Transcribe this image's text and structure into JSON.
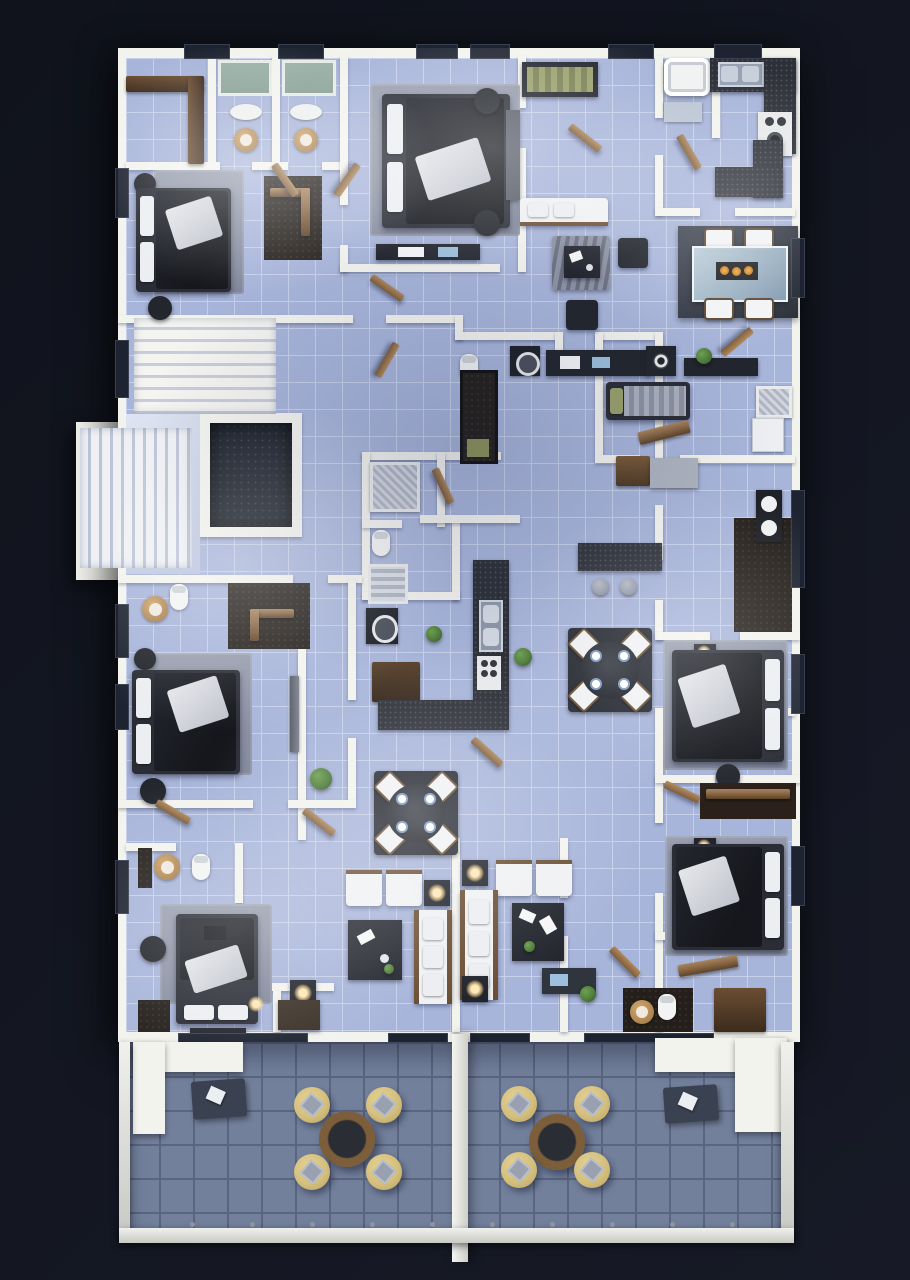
{
  "scene": {
    "type": "3d-floor-plan-render",
    "view": "top-down",
    "description": "Top-down 3D architectural render of a furnished residential apartment floor with a shared tiled terrace at the bottom",
    "visible_text": ""
  },
  "palette": {
    "bg": "#12151f",
    "wall": "#f3f3ee",
    "wall_shade": "#d7d8d4",
    "floor_tile": "#a8b5da",
    "floor_grout": "#c7d0ea",
    "terrace_tile": "#73809c",
    "terrace_grout": "#5a6580",
    "furniture_dark": "#22252d",
    "furniture_darker": "#16181e",
    "wood": "#8a6847",
    "wood_dark": "#5d4328",
    "wardrobe_brown": "#453226",
    "rug_gray": "#8f95a6",
    "chair_yellow": "#d4bf7d",
    "chair_yellow_rim": "#b7a262",
    "plant_green": "#4d7a3a",
    "tub_teal": "#849d93",
    "glass_blue": "#a9c0d2",
    "lamp_glow": "#ffe9b8",
    "counter_speckle": "#2d3038",
    "window_dark": "#1d2330"
  },
  "rooms": [
    {
      "id": "bedroom-top-left",
      "label": "Bedroom with double bed, rug and walk-in closet"
    },
    {
      "id": "twin-bathrooms-top",
      "label": "Two mirrored bathrooms with teal tubs, wood basins and toilets"
    },
    {
      "id": "bedroom-top-center",
      "label": "Master bedroom with large double bed and dresser"
    },
    {
      "id": "entry-lounge",
      "label": "Entry lounge with white sofa, zebra rug and dark armchairs"
    },
    {
      "id": "kitchen-top-right",
      "label": "Kitchen with dark counters, double sink, stove and glass dining table"
    },
    {
      "id": "stairwell",
      "label": "Staircase flights and landing"
    },
    {
      "id": "elevator",
      "label": "Elevator shaft"
    },
    {
      "id": "laundry-corridor",
      "label": "Corridor with washing machine and kitchenette counter"
    },
    {
      "id": "studio-mid-right",
      "label": "Studio room with single bed, desk, fridge and shower"
    },
    {
      "id": "bathroom-mid-right",
      "label": "Bathroom with double vanity on dark tile"
    },
    {
      "id": "bedroom-mid-left",
      "label": "Bedroom with double bed, TV wall and dark wardrobe"
    },
    {
      "id": "kitchen-center",
      "label": "Kitchen with L-counter, sink, stove and breakfast bar"
    },
    {
      "id": "dining-center",
      "label": "Round dining table with four chairs and plates"
    },
    {
      "id": "dining-left",
      "label": "Round dining table with four chairs and plates"
    },
    {
      "id": "living-room-left",
      "label": "Living room with white sofa, armchairs, coffee table, lamp table"
    },
    {
      "id": "living-room-right",
      "label": "Living room with white sofa, armchairs, coffee table, lamp tables"
    },
    {
      "id": "bedroom-right-1",
      "label": "Bedroom with double bed and glowing nightstands"
    },
    {
      "id": "bedroom-right-2",
      "label": "Bedroom with double bed and wardrobe corridor"
    },
    {
      "id": "bedroom-bottom-left",
      "label": "Bedroom with double bed and en-suite bathroom"
    },
    {
      "id": "bathroom-bottom-right",
      "label": "Bathroom with toilet, wood basin and wardrobe"
    },
    {
      "id": "terrace-left",
      "label": "Terrace with round table, four yellow tub chairs and mat"
    },
    {
      "id": "terrace-right",
      "label": "Terrace with round table, four yellow tub chairs and mat"
    }
  ],
  "furniture_inventory": {
    "double_beds": 6,
    "single_beds_daybeds": 2,
    "round_dining_tables_indoor": 2,
    "glass_dining_table": 1,
    "dining_chairs_per_table": 4,
    "breakfast_bar_stools": 2,
    "white_sofas": 3,
    "white_armchairs": 4,
    "dark_armchairs": 2,
    "terrace_tables": 2,
    "terrace_yellow_chairs": 8,
    "bathrooms": 6,
    "kitchens": 2,
    "washing_machine": 1,
    "elevator": 1,
    "stair_flights": 2,
    "plants": 5
  }
}
